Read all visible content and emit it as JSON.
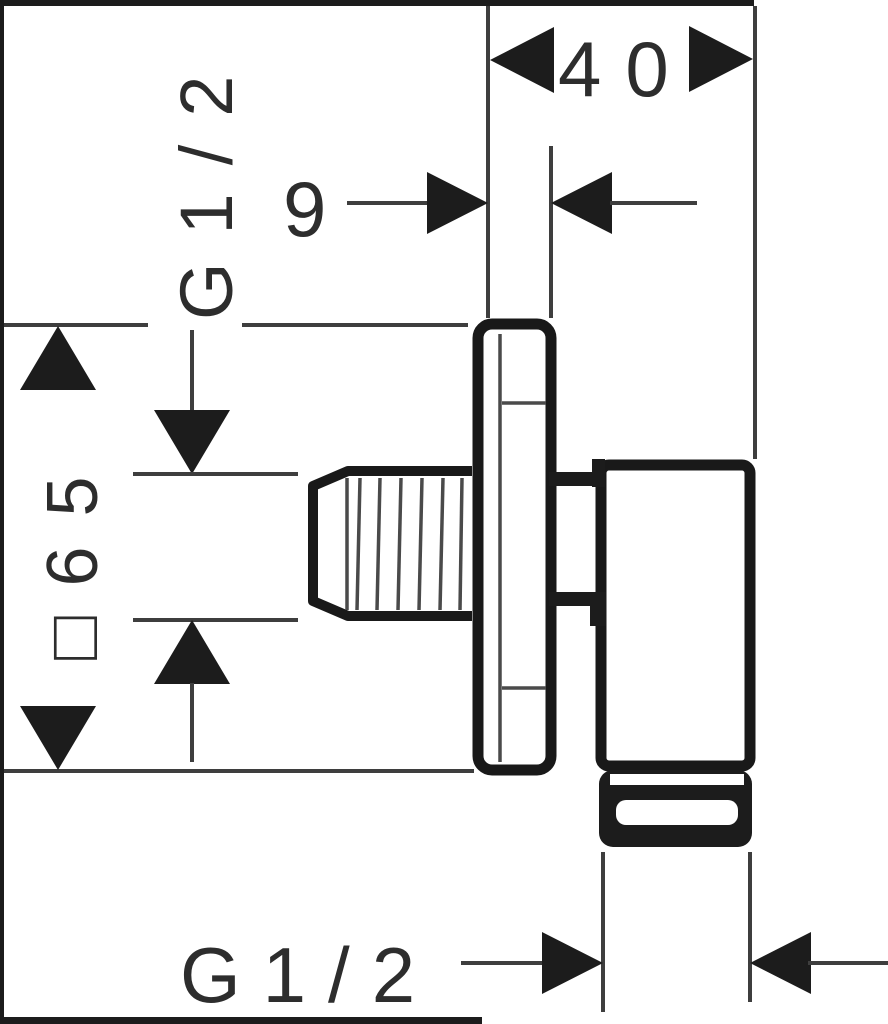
{
  "page": {
    "background": "#ffffff",
    "kind": "technical dimension drawing",
    "subject": "wall outlet elbow, side view with thread and size callouts"
  },
  "drawing": {
    "colors": {
      "outline": "#191919",
      "thin_line": "#3e3e3e",
      "arrow": "#1c1c1c",
      "text": "#2d2d2d"
    },
    "dimensions": {
      "depth_total": "40",
      "plate_offset": "9",
      "thread_inlet": "G1/2",
      "plate_square": "□65",
      "thread_outlet": "G1/2"
    }
  }
}
